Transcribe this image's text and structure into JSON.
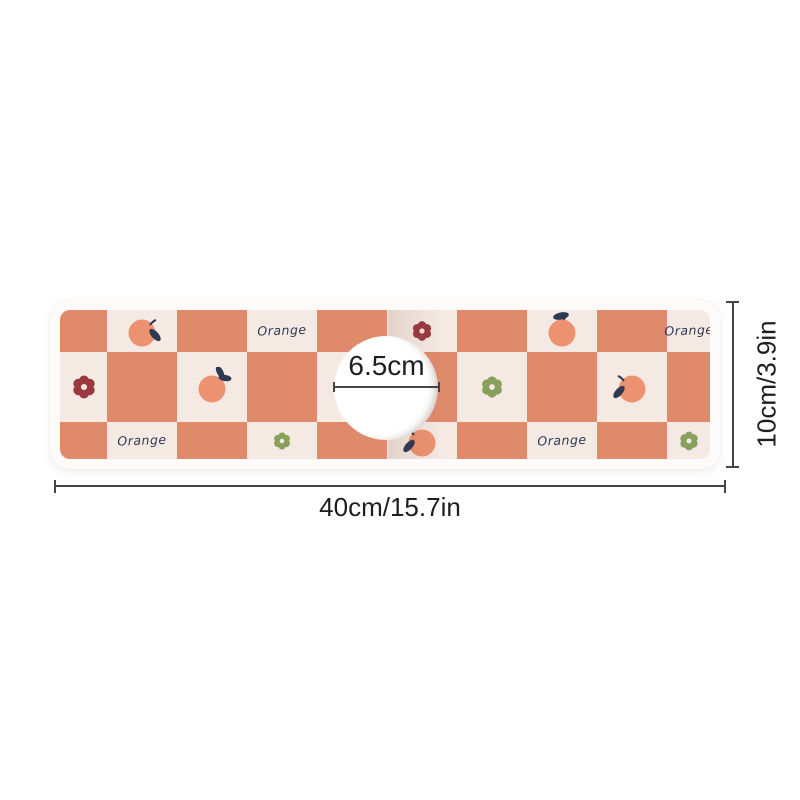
{
  "product_diagram": {
    "background_color": "#ffffff",
    "dimensions": {
      "hole_diameter": "6.5cm",
      "width": "40cm/15.7in",
      "height": "10cm/3.9in"
    },
    "annotation": {
      "line_color": "#454545",
      "text_color": "#1e1e1e"
    },
    "mat": {
      "base_color": "#fcfbfa",
      "pattern": {
        "label_text": "Orange",
        "colors": {
          "orange_square": "#df8a6b",
          "cream_square": "#f5e9e3",
          "fruit": "#ec9270",
          "leaf": "#2e3a52",
          "label": "#2e3a52",
          "red_flower": "#9c3840",
          "green_flower": "#87a05c"
        },
        "rows": 3,
        "cols": 10,
        "first_cell": "orange",
        "decorations": [
          {
            "row": 0,
            "col": 1,
            "type": "fruit",
            "variant": "leaf-right"
          },
          {
            "row": 0,
            "col": 3,
            "type": "label"
          },
          {
            "row": 0,
            "col": 5,
            "type": "flower",
            "color": "red",
            "size": 23
          },
          {
            "row": 0,
            "col": 7,
            "type": "fruit",
            "variant": "leaf-top"
          },
          {
            "row": 0,
            "col": 9,
            "type": "label"
          },
          {
            "row": 1,
            "col": 0,
            "type": "flower",
            "color": "red",
            "size": 27
          },
          {
            "row": 1,
            "col": 2,
            "type": "fruit",
            "variant": "two-leaves"
          },
          {
            "row": 1,
            "col": 6,
            "type": "flower",
            "color": "green",
            "size": 25
          },
          {
            "row": 1,
            "col": 8,
            "type": "fruit",
            "variant": "leaf-left"
          },
          {
            "row": 2,
            "col": 1,
            "type": "label"
          },
          {
            "row": 2,
            "col": 3,
            "type": "flower",
            "color": "green",
            "size": 20
          },
          {
            "row": 2,
            "col": 5,
            "type": "fruit",
            "variant": "leaf-left"
          },
          {
            "row": 2,
            "col": 7,
            "type": "label"
          },
          {
            "row": 2,
            "col": 9,
            "type": "flower",
            "color": "green",
            "size": 22
          }
        ]
      }
    }
  }
}
